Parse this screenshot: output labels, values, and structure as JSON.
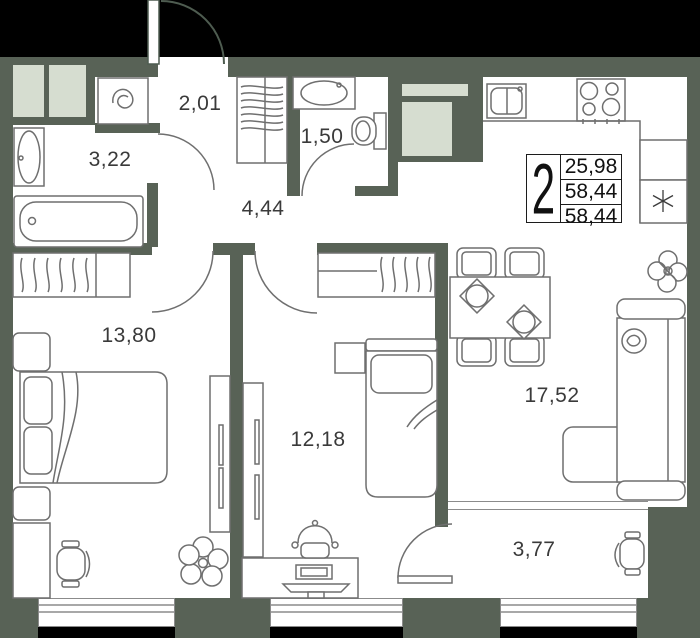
{
  "apartment": {
    "rooms_badge": "2",
    "stats": {
      "value1": "25,98",
      "value2": "58,44",
      "value3": "58,44"
    },
    "room_labels": {
      "bathroom": "3,22",
      "entry": "2,01",
      "wc": "1,50",
      "hallway": "4,44",
      "bedroom1": "13,80",
      "bedroom2": "12,18",
      "living_kitchen": "17,52",
      "balcony": "3,77"
    },
    "icons": [
      "bathtub-icon",
      "sink-icon",
      "toilet-icon",
      "washing-machine-icon",
      "stove-icon",
      "kitchen-sink-icon",
      "wardrobe-hangers-icon",
      "double-bed-icon",
      "single-bed-icon",
      "sofa-icon",
      "dining-table-icon",
      "chair-icon",
      "desk-icon",
      "monitor-icon",
      "plant-icon",
      "door-arc-icon",
      "asterisk-ac-icon",
      "window-icon"
    ],
    "colors": {
      "wall": "#586256",
      "shaft": "#d6ddd0",
      "floor": "#ffffff",
      "outside": "#000000",
      "line": "#6f6f6f"
    }
  }
}
